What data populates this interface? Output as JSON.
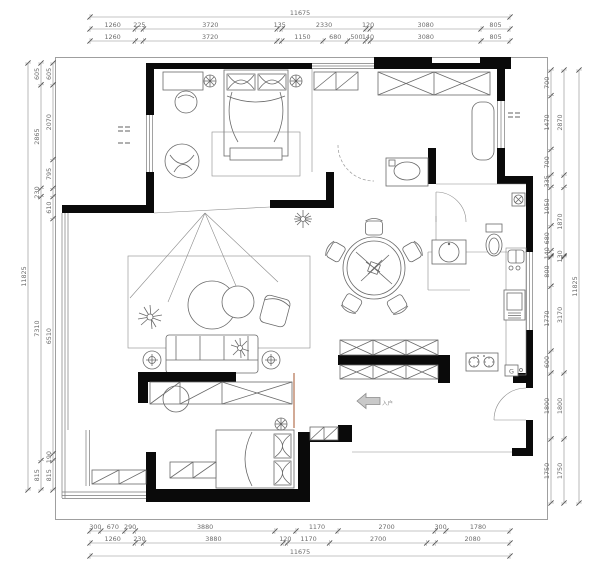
{
  "labels": {
    "gas_meter": "G",
    "entry_arrow": "入户"
  },
  "colors": {
    "wall": "#0a0a0a",
    "dim_text": "#6b6b6b",
    "furniture_line": "#6a6a6a",
    "door_track": "#b5724f"
  },
  "dims": {
    "top": {
      "total": [
        {
          "v": 11675,
          "t": "11675"
        }
      ],
      "row1": [
        {
          "v": 1260,
          "t": "1260"
        },
        {
          "v": 225,
          "t": "225"
        },
        {
          "v": 3720,
          "t": "3720"
        },
        {
          "v": 135,
          "t": "135"
        },
        {
          "v": 2330,
          "t": "2330"
        },
        {
          "v": 120,
          "t": "120"
        },
        {
          "v": 3080,
          "t": "3080"
        },
        {
          "v": 805,
          "t": "805"
        }
      ],
      "row2": [
        {
          "v": 1260,
          "t": "1260"
        },
        {
          "v": 225,
          "t": ""
        },
        {
          "v": 3720,
          "t": "3720"
        },
        {
          "v": 135,
          "t": ""
        },
        {
          "v": 1150,
          "t": "1150"
        },
        {
          "v": 680,
          "t": "680"
        },
        {
          "v": 500,
          "t": "500"
        },
        {
          "v": 140,
          "t": "140"
        },
        {
          "v": 3080,
          "t": "3080"
        },
        {
          "v": 805,
          "t": "805"
        }
      ]
    },
    "bottom": {
      "row1": [
        {
          "v": 300,
          "t": "300"
        },
        {
          "v": 670,
          "t": "670"
        },
        {
          "v": 290,
          "t": "290"
        },
        {
          "v": 3880,
          "t": "3880"
        },
        {
          "v": 585,
          "t": ""
        },
        {
          "v": 1170,
          "t": "1170"
        },
        {
          "v": 2700,
          "t": "2700"
        },
        {
          "v": 300,
          "t": "300"
        },
        {
          "v": 1780,
          "t": "1780"
        }
      ],
      "row2": [
        {
          "v": 1260,
          "t": "1260"
        },
        {
          "v": 230,
          "t": "230"
        },
        {
          "v": 3880,
          "t": "3880"
        },
        {
          "v": 120,
          "t": "120"
        },
        {
          "v": 1170,
          "t": "1170"
        },
        {
          "v": 2700,
          "t": "2700"
        },
        {
          "v": 235,
          "t": ""
        },
        {
          "v": 2080,
          "t": "2080"
        }
      ],
      "total": [
        {
          "v": 11675,
          "t": "11675"
        }
      ]
    },
    "left": {
      "total": [
        {
          "v": 11825,
          "t": "11825"
        }
      ],
      "outer": [
        {
          "v": 605,
          "t": "605"
        },
        {
          "v": 2865,
          "t": "2865"
        },
        {
          "v": 230,
          "t": "230"
        },
        {
          "v": 7310,
          "t": "7310"
        },
        {
          "v": 815,
          "t": "815"
        }
      ],
      "inner": [
        {
          "v": 605,
          "t": "605"
        },
        {
          "v": 2070,
          "t": "2070"
        },
        {
          "v": 795,
          "t": "795"
        },
        {
          "v": 230,
          "t": ""
        },
        {
          "v": 610,
          "t": "610"
        },
        {
          "v": 6510,
          "t": "6510"
        },
        {
          "v": 190,
          "t": "190"
        },
        {
          "v": 815,
          "t": "815"
        }
      ]
    },
    "right": {
      "inner": [
        {
          "v": 700,
          "t": "700"
        },
        {
          "v": 1470,
          "t": "1470"
        },
        {
          "v": 700,
          "t": "700"
        },
        {
          "v": 335,
          "t": "335"
        },
        {
          "v": 1050,
          "t": "1050"
        },
        {
          "v": 680,
          "t": "680"
        },
        {
          "v": 140,
          "t": "140"
        },
        {
          "v": 30,
          "t": ""
        },
        {
          "v": 800,
          "t": "800"
        },
        {
          "v": 1770,
          "t": "1770"
        },
        {
          "v": 600,
          "t": "600"
        },
        {
          "v": 1800,
          "t": "1800"
        },
        {
          "v": 1750,
          "t": "1750"
        }
      ],
      "mid": [
        {
          "v": 2870,
          "t": "2870"
        },
        {
          "v": 335,
          "t": ""
        },
        {
          "v": 1870,
          "t": "1870"
        },
        {
          "v": 30,
          "t": "130"
        },
        {
          "v": 3170,
          "t": "3170"
        },
        {
          "v": 1800,
          "t": "1800"
        },
        {
          "v": 1750,
          "t": "1750"
        }
      ],
      "total": [
        {
          "v": 11825,
          "t": "11825"
        }
      ]
    }
  }
}
